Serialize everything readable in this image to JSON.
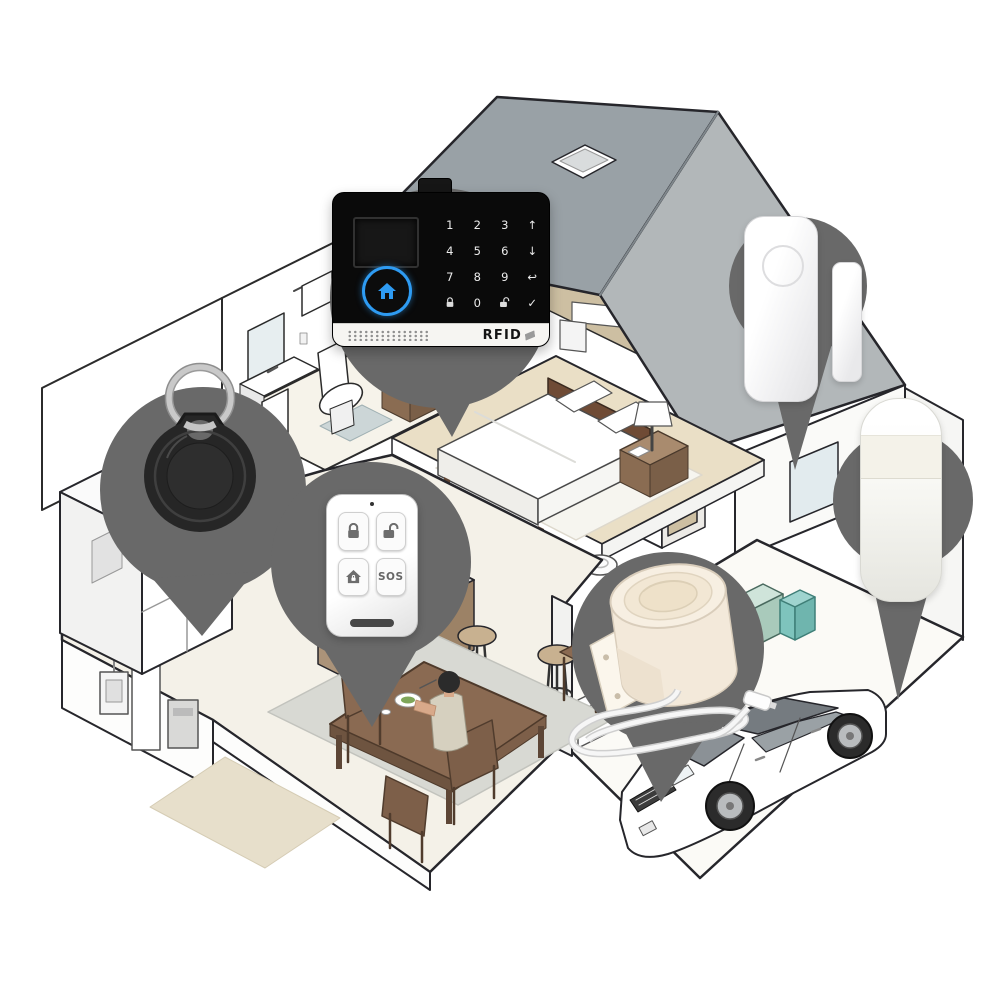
{
  "meta": {
    "description": "Smart home WiFi/GSM security alarm kit shown on dark location pins over an isometric cutaway house illustration",
    "canvas": {
      "width": 1000,
      "height": 1000
    }
  },
  "colors": {
    "pin_gray": "#696969",
    "panel_black": "#0a0a0a",
    "panel_accent_blue": "#2e9bf2",
    "roof_left": "#99a1a6",
    "roof_right": "#b2b7b9",
    "floor_tan": "#eadfc6",
    "wood_brown": "#8a6a52",
    "cabinet_tan": "#b7a88f",
    "bowl_blue": "#3f6fae",
    "towel_blue": "#8fc3dd",
    "storage_teal": "#9fd4cf",
    "siren_cream": "#f6ecdd"
  },
  "alarm_panel": {
    "name": "wifi-gsm-alarm-control-panel",
    "rfid_label": "RFID",
    "keys": [
      "1",
      "2",
      "3",
      "↑",
      "4",
      "5",
      "6",
      "↓",
      "7",
      "8",
      "9",
      "↩",
      "lock-icon",
      "0",
      "unlock-icon",
      "✓"
    ]
  },
  "remote_control": {
    "name": "remote-keyfob-controller",
    "sos_label": "SOS",
    "buttons": [
      "lock-icon",
      "unlock-icon",
      "home-arm-icon",
      "SOS"
    ]
  },
  "devices": [
    {
      "id": "alarm-panel",
      "label": "Alarm control panel with RFID reader"
    },
    {
      "id": "door-window-sensor",
      "label": "Door/window magnetic sensor"
    },
    {
      "id": "pir-motion-sensor",
      "label": "PIR motion sensor"
    },
    {
      "id": "rfid-keyfob",
      "label": "RFID tag keyfob"
    },
    {
      "id": "remote-control",
      "label": "Remote control with SOS button"
    },
    {
      "id": "wired-siren",
      "label": "Wired horn siren with cable"
    }
  ]
}
